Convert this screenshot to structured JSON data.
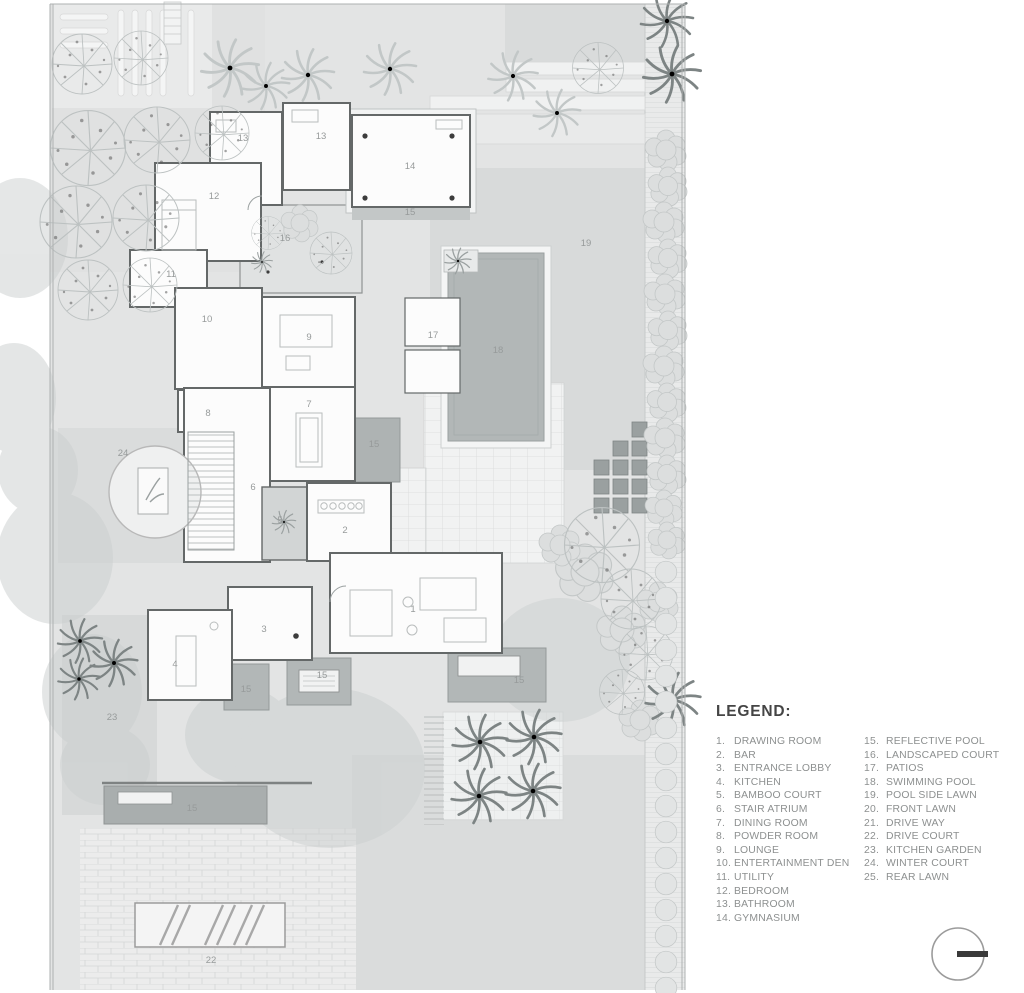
{
  "legend": {
    "title": "LEGEND:",
    "column1": [
      {
        "n": "1.",
        "label": "DRAWING ROOM"
      },
      {
        "n": "2.",
        "label": "BAR"
      },
      {
        "n": "3.",
        "label": "ENTRANCE LOBBY"
      },
      {
        "n": "4.",
        "label": "KITCHEN"
      },
      {
        "n": "5.",
        "label": "BAMBOO COURT"
      },
      {
        "n": "6.",
        "label": "STAIR ATRIUM"
      },
      {
        "n": "7.",
        "label": "DINING ROOM"
      },
      {
        "n": "8.",
        "label": "POWDER ROOM"
      },
      {
        "n": "9.",
        "label": "LOUNGE"
      },
      {
        "n": "10.",
        "label": "ENTERTAINMENT DEN"
      },
      {
        "n": "11.",
        "label": "UTILITY"
      },
      {
        "n": "12.",
        "label": "BEDROOM"
      },
      {
        "n": "13.",
        "label": "BATHROOM"
      },
      {
        "n": "14.",
        "label": "GYMNASIUM"
      }
    ],
    "column2": [
      {
        "n": "15.",
        "label": "REFLECTIVE POOL"
      },
      {
        "n": "16.",
        "label": "LANDSCAPED COURT"
      },
      {
        "n": "17.",
        "label": "PATIOS"
      },
      {
        "n": "18.",
        "label": "SWIMMING POOL"
      },
      {
        "n": "19.",
        "label": "POOL SIDE LAWN"
      },
      {
        "n": "20.",
        "label": "FRONT LAWN"
      },
      {
        "n": "21.",
        "label": "DRIVE WAY"
      },
      {
        "n": "22.",
        "label": "DRIVE COURT"
      },
      {
        "n": "23.",
        "label": "KITCHEN GARDEN"
      },
      {
        "n": "24.",
        "label": "WINTER COURT"
      },
      {
        "n": "25.",
        "label": "REAR LAWN"
      }
    ]
  },
  "plan_labels": [
    {
      "n": "13",
      "x": 243,
      "y": 141
    },
    {
      "n": "13",
      "x": 321,
      "y": 139
    },
    {
      "n": "14",
      "x": 410,
      "y": 169
    },
    {
      "n": "12",
      "x": 214,
      "y": 199
    },
    {
      "n": "15",
      "x": 410,
      "y": 215
    },
    {
      "n": "16",
      "x": 285,
      "y": 241
    },
    {
      "n": "19",
      "x": 586,
      "y": 246
    },
    {
      "n": "11",
      "x": 171,
      "y": 277
    },
    {
      "n": "10",
      "x": 207,
      "y": 322
    },
    {
      "n": "9",
      "x": 309,
      "y": 340
    },
    {
      "n": "17",
      "x": 433,
      "y": 338
    },
    {
      "n": "18",
      "x": 498,
      "y": 353
    },
    {
      "n": "8",
      "x": 208,
      "y": 416
    },
    {
      "n": "7",
      "x": 309,
      "y": 407
    },
    {
      "n": "24",
      "x": 123,
      "y": 456
    },
    {
      "n": "15",
      "x": 374,
      "y": 447
    },
    {
      "n": "6",
      "x": 253,
      "y": 490
    },
    {
      "n": "5",
      "x": 280,
      "y": 523
    },
    {
      "n": "2",
      "x": 345,
      "y": 533
    },
    {
      "n": "1",
      "x": 413,
      "y": 612
    },
    {
      "n": "3",
      "x": 264,
      "y": 632
    },
    {
      "n": "4",
      "x": 175,
      "y": 667
    },
    {
      "n": "15",
      "x": 246,
      "y": 692
    },
    {
      "n": "15",
      "x": 322,
      "y": 678
    },
    {
      "n": "15",
      "x": 519,
      "y": 683
    },
    {
      "n": "23",
      "x": 112,
      "y": 720
    },
    {
      "n": "15",
      "x": 192,
      "y": 811
    },
    {
      "n": "22",
      "x": 211,
      "y": 963
    }
  ],
  "colors": {
    "site": "#e3e4e4",
    "lawn": "#d8dada",
    "pool": "#b2b7b7",
    "reflective_pool": "#a9aeae",
    "wall": "#646868",
    "room": "#fcfcfc",
    "plan_label": "#979b9b",
    "legend_text": "#8d9090",
    "legend_title": "#454545"
  }
}
